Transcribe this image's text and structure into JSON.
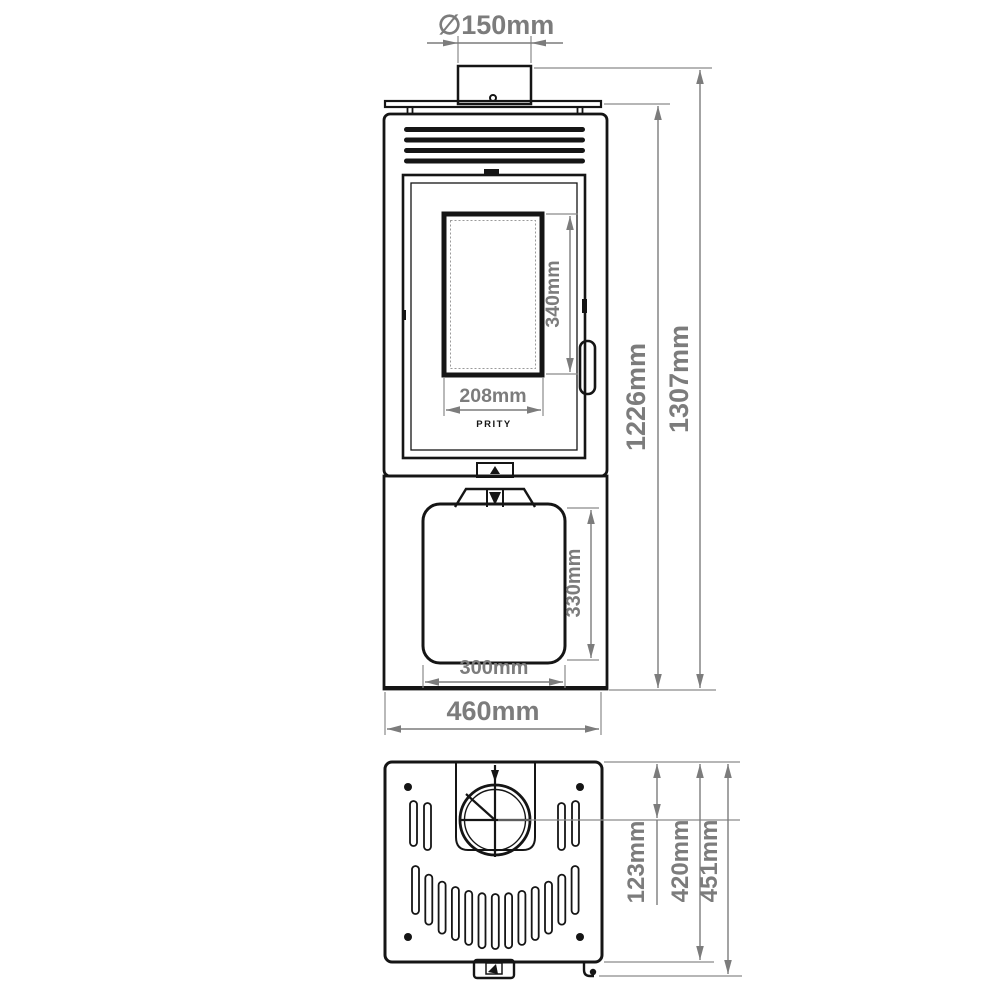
{
  "drawing": {
    "brand_logo": "PRITY",
    "colors": {
      "outline": "#151515",
      "dimension": "#7c7c7c",
      "background": "#ffffff"
    },
    "front_view": {
      "dimensions": {
        "flue_diameter": "∅150mm",
        "glass_height": "340mm",
        "glass_width": "208mm",
        "body_height": "1226mm",
        "total_height": "1307mm",
        "lower_door_height": "330mm",
        "lower_door_width": "300mm",
        "overall_width": "460mm"
      }
    },
    "top_view": {
      "dimensions": {
        "flue_center_offset": "123mm",
        "depth_body": "420mm",
        "depth_total": "451mm"
      }
    }
  }
}
